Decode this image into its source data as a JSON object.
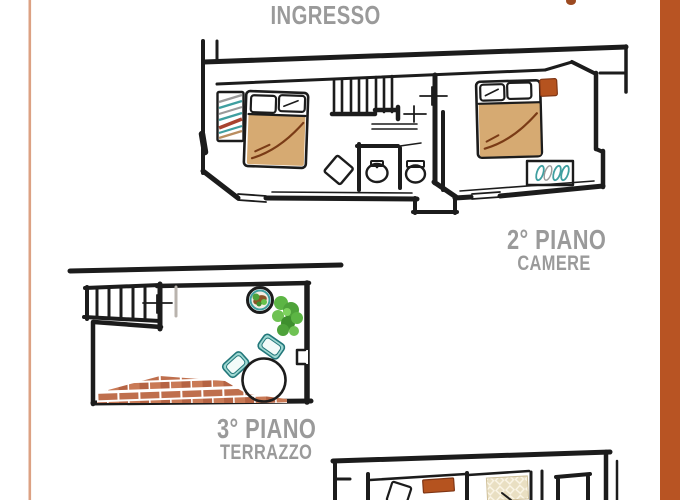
{
  "labels": {
    "entrance": "INGRESSO",
    "floor2": {
      "title": "2° PIANO",
      "subtitle": "CAMERE"
    },
    "floor3": {
      "title": "3° PIANO",
      "subtitle": "TERRAZZO"
    }
  },
  "plans": {
    "floor2": {
      "name": "secondo piano - camere",
      "elements": [
        "double-bed",
        "wardrobe-hangers",
        "stairs",
        "window-cross",
        "bathroom-sink",
        "bathroom-toilet",
        "side-chair",
        "double-bed",
        "orange-nightstand",
        "teal-shelf"
      ]
    },
    "floor3": {
      "name": "terzo piano - terrazzo",
      "elements": [
        "stairs",
        "glass-door",
        "window-cross",
        "potted-plant",
        "green-plant",
        "round-table",
        "teal-chair",
        "teal-chair",
        "brick-floor",
        "wall-notch"
      ]
    },
    "floor1_partial": {
      "name": "piano inferiore (parziale)",
      "elements": [
        "side-chair",
        "orange-cabinet",
        "lattice-rug",
        "door-frame",
        "walls"
      ]
    }
  },
  "colors": {
    "wall": "#1c1c1c",
    "text": "#9a9a9a",
    "blanket": "#d6aa72",
    "blanket_line": "#7a3b16",
    "nightstand": "#b5531f",
    "teal": "#3f9fa0",
    "brick": "#bf6f4d",
    "brick_alt1": "#b56343",
    "brick_alt2": "#c97a56",
    "plant_green": "#5cb544",
    "plant_dark": "#3e8f2e",
    "rug_base": "#e9dfc2",
    "rug_line": "#fbf6e8",
    "chair_fill": "#9fd8d2",
    "chair_border": "#22777a",
    "left_line": "#dca183",
    "right_bar": "#b85423",
    "top_dot": "#9c4a21"
  }
}
